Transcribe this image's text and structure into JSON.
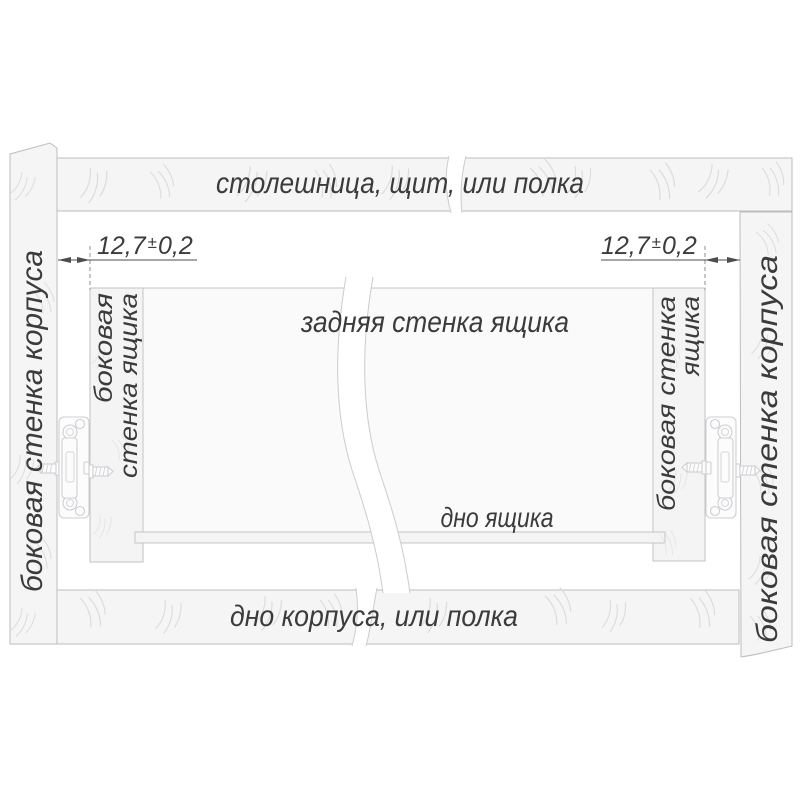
{
  "diagram": {
    "title_hint": "drawer slide mounting clearance diagram",
    "top_panel_label": "столешница, щит, или полка",
    "bottom_panel_label": "дно корпуса, или полка",
    "left_wall_label": "боковая стенка корпуса",
    "right_wall_label": "боковая стенка корпуса",
    "back_wall_label": "задняя стенка ящика",
    "drawer_bottom_label": "дно ящика",
    "left_drawer_wall": {
      "line1": "боковая",
      "line2": "стенка ящика"
    },
    "right_drawer_wall": {
      "line1": "боковая стенка",
      "line2": "ящика"
    },
    "dimension_left": {
      "value": "12,7",
      "pm": "±",
      "tolerance": "0,2"
    },
    "dimension_right": {
      "value": "12,7",
      "pm": "±",
      "tolerance": "0,2"
    },
    "colors": {
      "background": "#ffffff",
      "panel_fill": "#f5f5f6",
      "outline": "#bdbdbd",
      "wood_grain": "#dcdcdc",
      "rail": "#cfcfd3",
      "dimension": "#4d4d4d",
      "text": "#3b3b3b"
    }
  }
}
